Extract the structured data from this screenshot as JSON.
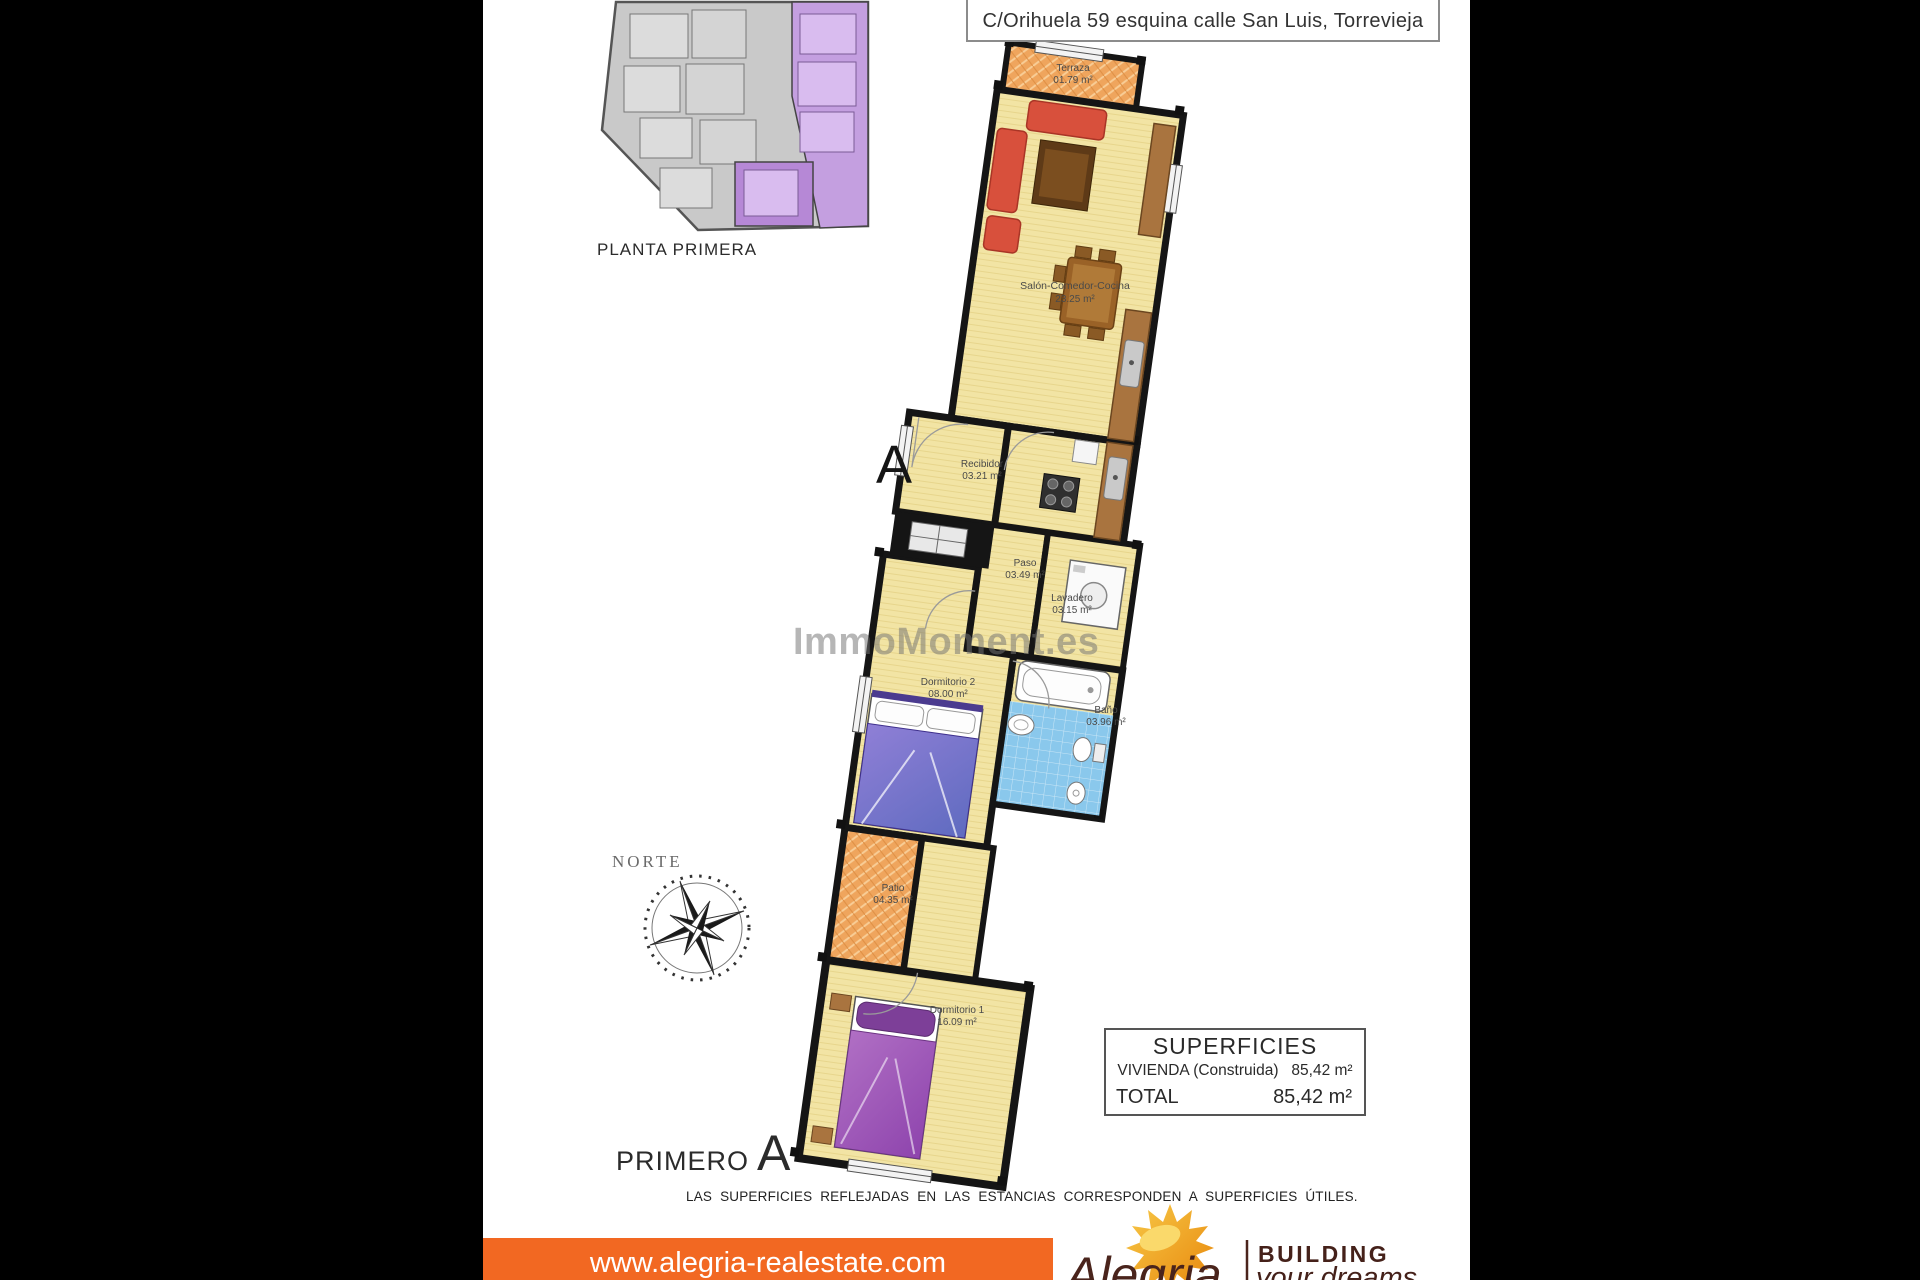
{
  "header": {
    "address_title": "C/Orihuela 59 esquina calle San Luis, Torrevieja"
  },
  "site_plan": {
    "label": "PLANTA PRIMERA"
  },
  "section_marker": "A",
  "watermark": "ImmoMoment.es",
  "compass": {
    "label": "NORTE"
  },
  "plan": {
    "rooms": [
      {
        "name": "Terraza",
        "area": "01.79 m²"
      },
      {
        "name": "Salón-Comedor-Cocina",
        "area": "23.25 m²"
      },
      {
        "name": "Recibidor",
        "area": "03.21 m²"
      },
      {
        "name": "Paso",
        "area": "03.49 m²"
      },
      {
        "name": "Lavadero",
        "area": "03.15 m²"
      },
      {
        "name": "Baño",
        "area": "03.96 m²"
      },
      {
        "name": "Dormitorio 2",
        "area": "08.00 m²"
      },
      {
        "name": "Patio",
        "area": "04.35 m²"
      },
      {
        "name": "Dormitorio 1",
        "area": "16.09 m²"
      }
    ]
  },
  "surfaces": {
    "title": "SUPERFICIES",
    "row1_label": "VIVIENDA (Construida)",
    "row1_value": "85,42 m²",
    "row2_label": "TOTAL",
    "row2_value": "85,42 m²"
  },
  "floor_label": {
    "text": "PRIMERO",
    "letter": "A"
  },
  "disclaimer": "LAS SUPERFICIES REFLEJADAS EN LAS ESTANCIAS CORRESPONDEN A SUPERFICIES ÚTILES.",
  "footer": {
    "website": "www.alegria-realestate.com",
    "brand": "Alegria",
    "tagline_line1": "BUILDING",
    "tagline_line2": "your dreams"
  },
  "colors": {
    "footer_orange": "#F26822",
    "unit_highlight_purple": "#B688D6",
    "floor_yellow": "#F2E4A4",
    "terrace_orange": "#EFA55D",
    "bath_blue": "#8AC8EC",
    "sofa_red": "#D8503C",
    "bed_purple": "#8E44AD",
    "brand_brown": "#45211A"
  }
}
